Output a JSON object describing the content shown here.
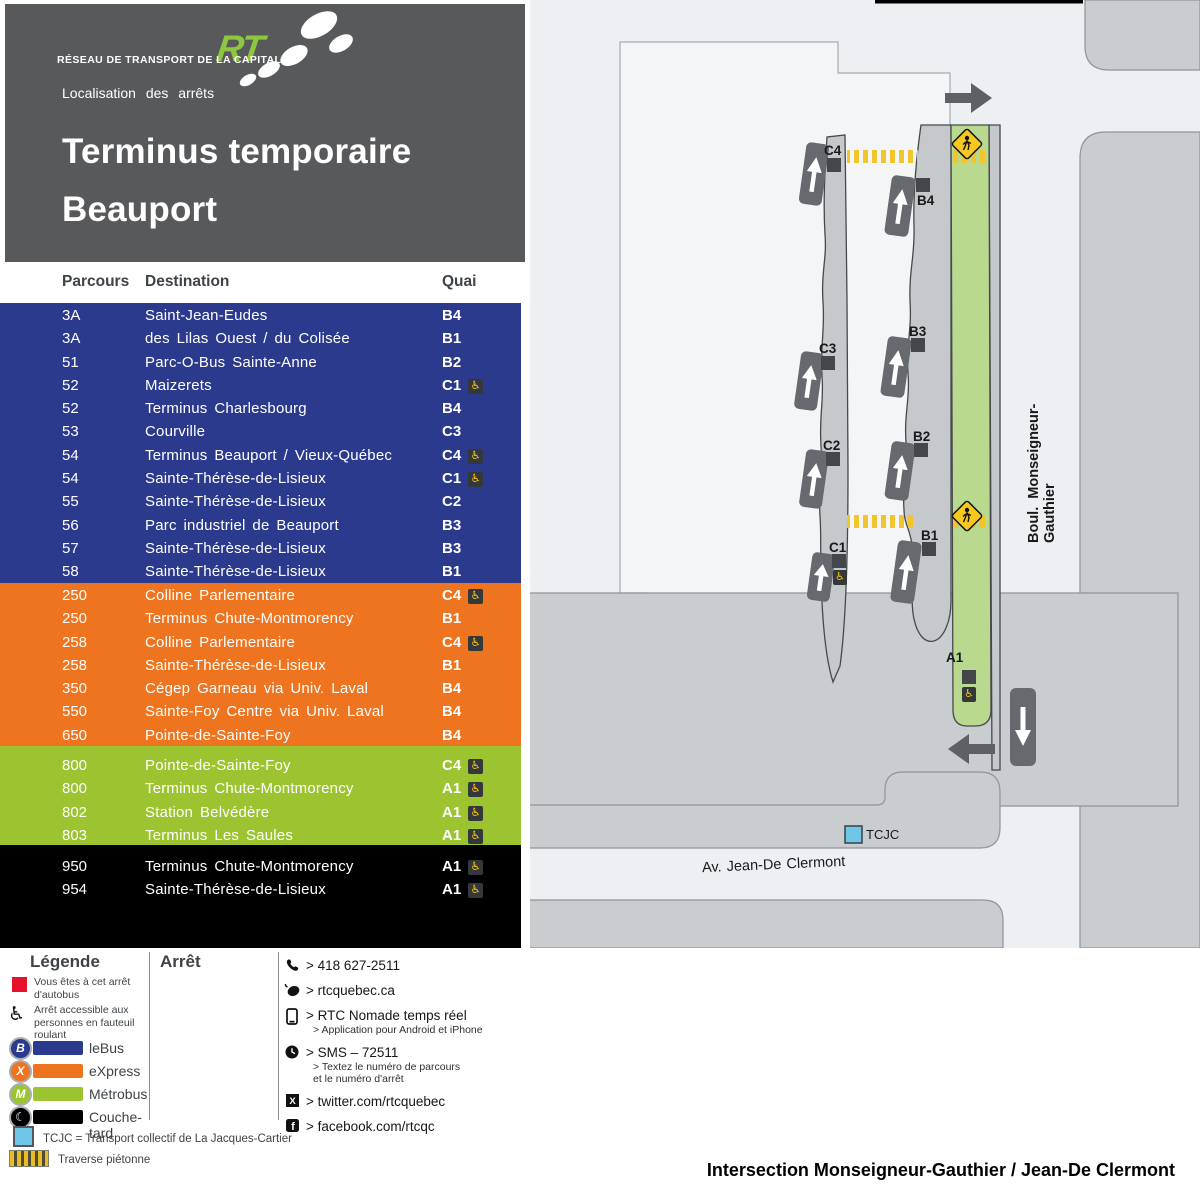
{
  "header": {
    "agency": "RÉSEAU DE TRANSPORT DE LA CAPITALE",
    "logo_text": "RTC",
    "subtitle": "Localisation des arrêts",
    "title_line1": "Terminus temporaire",
    "title_line2": "Beauport"
  },
  "table": {
    "columns": {
      "parcours": "Parcours",
      "destination": "Destination",
      "quai": "Quai"
    },
    "sections": [
      {
        "name": "leBus",
        "color": "#2c3a8e",
        "rows": [
          {
            "parcours": "3A",
            "destination": "Saint-Jean-Eudes",
            "quai": "B4",
            "accessible": false
          },
          {
            "parcours": "3A",
            "destination": "des Lilas Ouest / du Colisée",
            "quai": "B1",
            "accessible": false
          },
          {
            "parcours": "51",
            "destination": "Parc-O-Bus Sainte-Anne",
            "quai": "B2",
            "accessible": false
          },
          {
            "parcours": "52",
            "destination": "Maizerets",
            "quai": "C1",
            "accessible": true
          },
          {
            "parcours": "52",
            "destination": "Terminus Charlesbourg",
            "quai": "B4",
            "accessible": false
          },
          {
            "parcours": "53",
            "destination": "Courville",
            "quai": "C3",
            "accessible": false
          },
          {
            "parcours": "54",
            "destination": "Terminus Beauport / Vieux-Québec",
            "quai": "C4",
            "accessible": true
          },
          {
            "parcours": "54",
            "destination": "Sainte-Thérèse-de-Lisieux",
            "quai": "C1",
            "accessible": true
          },
          {
            "parcours": "55",
            "destination": "Sainte-Thérèse-de-Lisieux",
            "quai": "C2",
            "accessible": false
          },
          {
            "parcours": "56",
            "destination": "Parc industriel de Beauport",
            "quai": "B3",
            "accessible": false
          },
          {
            "parcours": "57",
            "destination": "Sainte-Thérèse-de-Lisieux",
            "quai": "B3",
            "accessible": false
          },
          {
            "parcours": "58",
            "destination": "Sainte-Thérèse-de-Lisieux",
            "quai": "B1",
            "accessible": false
          }
        ]
      },
      {
        "name": "eXpress",
        "color": "#ee7420",
        "rows": [
          {
            "parcours": "250",
            "destination": "Colline Parlementaire",
            "quai": "C4",
            "accessible": true
          },
          {
            "parcours": "250",
            "destination": "Terminus Chute-Montmorency",
            "quai": "B1",
            "accessible": false
          },
          {
            "parcours": "258",
            "destination": "Colline Parlementaire",
            "quai": "C4",
            "accessible": true
          },
          {
            "parcours": "258",
            "destination": "Sainte-Thérèse-de-Lisieux",
            "quai": "B1",
            "accessible": false
          },
          {
            "parcours": "350",
            "destination": "Cégep Garneau via Univ. Laval",
            "quai": "B4",
            "accessible": false
          },
          {
            "parcours": "550",
            "destination": "Sainte-Foy Centre via Univ. Laval",
            "quai": "B4",
            "accessible": false
          },
          {
            "parcours": "650",
            "destination": "Pointe-de-Sainte-Foy",
            "quai": "B4",
            "accessible": false
          }
        ]
      },
      {
        "name": "Métrobus",
        "color": "#9cc431",
        "rows": [
          {
            "parcours": "800",
            "destination": "Pointe-de-Sainte-Foy",
            "quai": "C4",
            "accessible": true
          },
          {
            "parcours": "800",
            "destination": "Terminus Chute-Montmorency",
            "quai": "A1",
            "accessible": true
          },
          {
            "parcours": "802",
            "destination": "Station Belvédère",
            "quai": "A1",
            "accessible": true
          },
          {
            "parcours": "803",
            "destination": "Terminus Les Saules",
            "quai": "A1",
            "accessible": true
          }
        ]
      },
      {
        "name": "Couche-tard",
        "color": "#000000",
        "rows": [
          {
            "parcours": "950",
            "destination": "Terminus Chute-Montmorency",
            "quai": "A1",
            "accessible": true
          },
          {
            "parcours": "954",
            "destination": "Sainte-Thérèse-de-Lisieux",
            "quai": "A1",
            "accessible": true
          }
        ]
      }
    ]
  },
  "legend": {
    "title": "Légende",
    "arret_title": "Arrêt",
    "you_are_here": "Vous êtes à cet arrêt d'autobus",
    "accessible": "Arrêt accessible aux personnes en fauteuil roulant",
    "modes": [
      {
        "label": "leBus",
        "color": "#2c3a8e",
        "symbol": "B"
      },
      {
        "label": "eXpress",
        "color": "#ee7420",
        "symbol": "X"
      },
      {
        "label": "Métrobus",
        "color": "#9cc431",
        "symbol": "M"
      },
      {
        "label": "Couche-tard",
        "color": "#000000",
        "symbol": "☾"
      }
    ],
    "tcjc": "TCJC = Transport collectif de La Jacques-Cartier",
    "crosswalk": "Traverse piétonne"
  },
  "contact": {
    "items": [
      {
        "icon": "phone",
        "text": "> 418 627-2511",
        "sub": []
      },
      {
        "icon": "mouse",
        "text": "> rtcquebec.ca",
        "sub": []
      },
      {
        "icon": "mobile",
        "text": "> RTC Nomade temps réel",
        "sub": [
          "> Application pour Android et iPhone"
        ]
      },
      {
        "icon": "clock",
        "text": "> SMS – 72511",
        "sub": [
          "> Textez le numéro de parcours",
          "et le numéro d'arrêt"
        ]
      },
      {
        "icon": "twitter",
        "text": "> twitter.com/rtcquebec",
        "sub": []
      },
      {
        "icon": "facebook",
        "text": "> facebook.com/rtcqc",
        "sub": []
      }
    ]
  },
  "map": {
    "stops": [
      {
        "label": "C4",
        "accessible": false
      },
      {
        "label": "B4",
        "accessible": false
      },
      {
        "label": "C3",
        "accessible": false
      },
      {
        "label": "B3",
        "accessible": false
      },
      {
        "label": "C2",
        "accessible": false
      },
      {
        "label": "B2",
        "accessible": false
      },
      {
        "label": "C1",
        "accessible": true
      },
      {
        "label": "B1",
        "accessible": false
      },
      {
        "label": "A1",
        "accessible": true
      }
    ],
    "street_vertical": "Boul. Monseigneur-Gauthier",
    "street_horizontal": "Av. Jean-De Clermont",
    "tcjc_label": "TCJC"
  },
  "caption": "Intersection Monseigneur-Gauthier / Jean-De Clermont"
}
